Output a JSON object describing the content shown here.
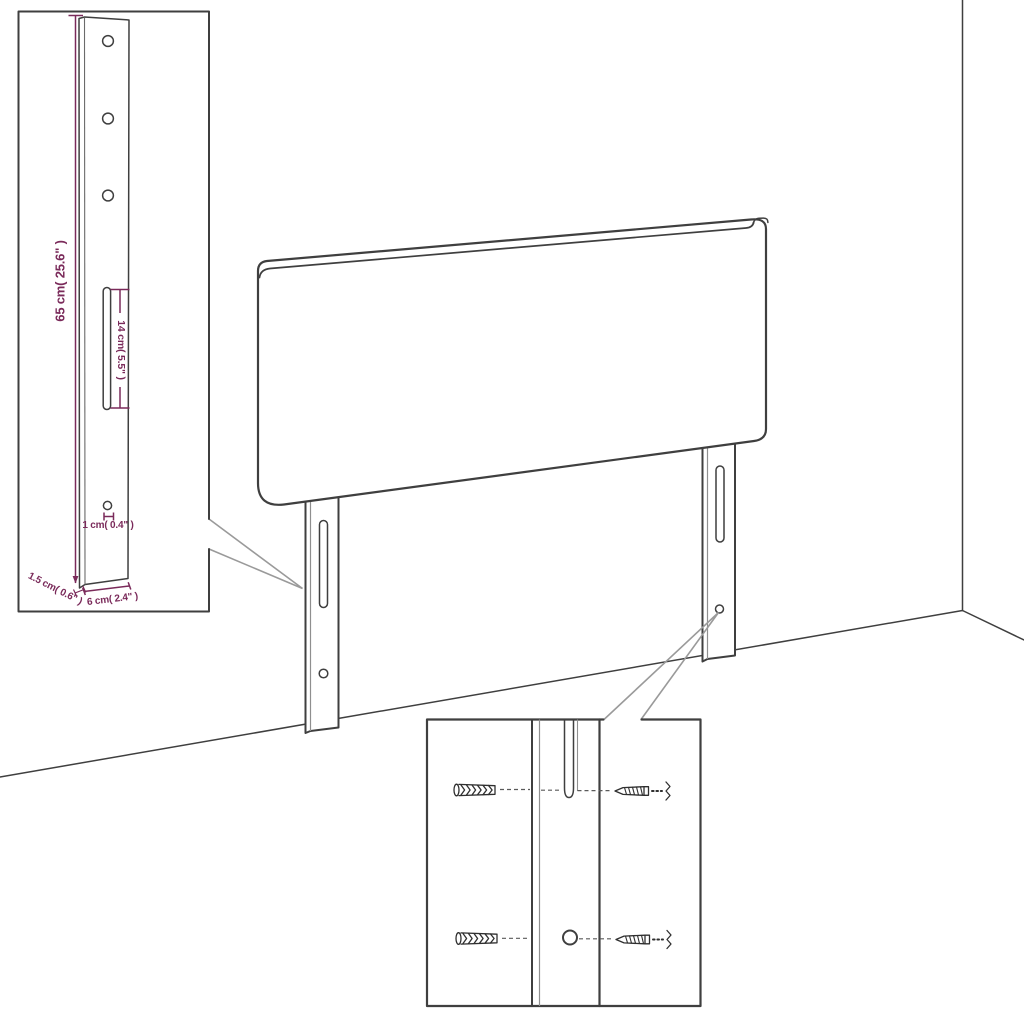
{
  "colors": {
    "background": "#ffffff",
    "outline": "#3f3f3f",
    "inner-line": "#8f8f8f",
    "callout": "#9a9a9a",
    "dimension": "#7a2a5a",
    "hardware": "#2f2f2f"
  },
  "bracket_inset": {
    "labels": {
      "total_height": "65 cm( 25.6\" )",
      "slot_length": "14 cm( 5.5\" )",
      "hole_size": "1 cm( 0.4\" )",
      "thickness": "1.5 cm( 0.6\" )",
      "width": "6 cm( 2.4\" )"
    }
  }
}
